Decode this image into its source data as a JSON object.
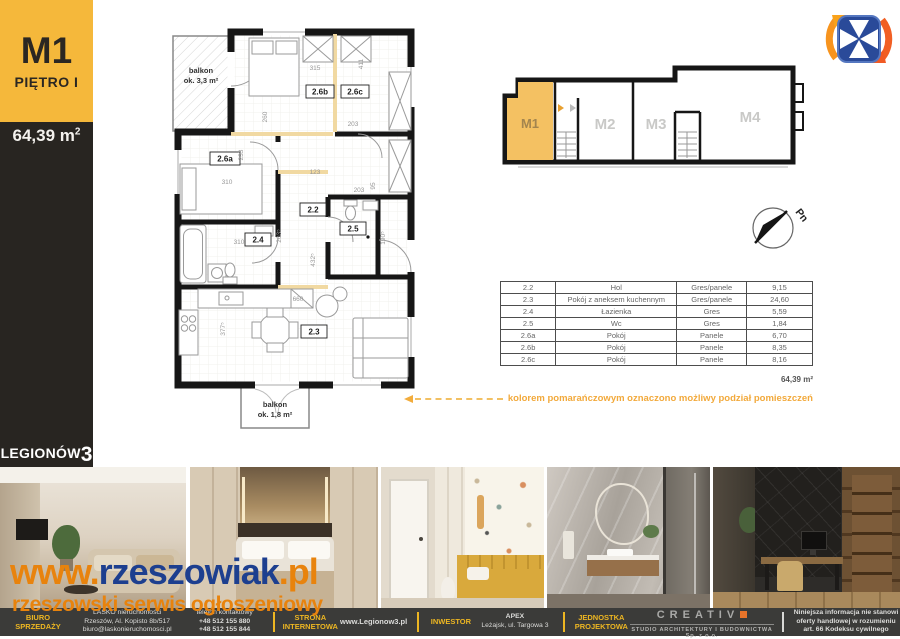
{
  "sidebar": {
    "unit": "M1",
    "floor": "PIĘTRO I",
    "area": "64,39 m",
    "area_sup": "2",
    "project_name": "LEGIONÓW",
    "project_number": "3"
  },
  "plan": {
    "balcony_top": {
      "label": "balkon",
      "area": "ok. 3,3 m²"
    },
    "balcony_bottom": {
      "label": "balkon",
      "area": "ok. 1,8 m²"
    },
    "rooms": {
      "r26a": "2.6a",
      "r26b": "2.6b",
      "r26c": "2.6c",
      "r22": "2.2",
      "r23": "2.3",
      "r24": "2.4",
      "r25": "2.5"
    },
    "dims": {
      "d315": "315",
      "d411": "411",
      "d260": "260",
      "d203a": "203",
      "d233": "233",
      "d310a": "310",
      "d123": "123",
      "d203b": "203",
      "d95": "95",
      "d310b": "310",
      "d2035": "203⁵",
      "d4325": "432⁵",
      "d1905": "190⁵",
      "d660": "660",
      "d3775": "377⁵"
    }
  },
  "overview": {
    "m1": "M1",
    "m2": "M2",
    "m3": "M3",
    "m4": "M4"
  },
  "compass": {
    "label": "Pn"
  },
  "table": {
    "rows": [
      {
        "id": "2.2",
        "name": "Hol",
        "floor": "Gres/panele",
        "area": "9,15"
      },
      {
        "id": "2.3",
        "name": "Pokój z aneksem kuchennym",
        "floor": "Gres/panele",
        "area": "24,60"
      },
      {
        "id": "2.4",
        "name": "Łazienka",
        "floor": "Gres",
        "area": "5,59"
      },
      {
        "id": "2.5",
        "name": "Wc",
        "floor": "Gres",
        "area": "1,84"
      },
      {
        "id": "2.6a",
        "name": "Pokój",
        "floor": "Panele",
        "area": "6,70"
      },
      {
        "id": "2.6b",
        "name": "Pokój",
        "floor": "Panele",
        "area": "8,35"
      },
      {
        "id": "2.6c",
        "name": "Pokój",
        "floor": "Panele",
        "area": "8,16"
      }
    ],
    "total": "64,39  m²"
  },
  "note": {
    "text": "kolorem pomarańczowym oznaczono możliwy podział pomieszczeń"
  },
  "watermark": {
    "prefix": "www.",
    "name": "rzeszowiak",
    "tld": ".pl",
    "tagline": "rzeszowski serwis ogłoszeniowy"
  },
  "footer": {
    "office_label_line1": "BIURO",
    "office_label_line2": "SPRZEDAŻY",
    "office_name": "LASKO nieruchomości",
    "office_address": "Rzeszów, Al. Kopisto 8b/517",
    "office_email": "biuro@laskonieruchomosci.pl",
    "phone_label": "telefon kontaktowy",
    "phone_1": "+48 512 155 880",
    "phone_2": "+48 512 155 844",
    "website_label_line1": "STRONA",
    "website_label_line2": "INTERNETOWA",
    "website_url": "www.Legionow3.pl",
    "investor_label": "INWESTOR",
    "investor_name": "APEX",
    "investor_address": "Leżajsk, ul. Targowa 3",
    "design_label_line1": "JEDNOSTKA",
    "design_label_line2": "PROJEKTOWA",
    "design_name": "CREATIV",
    "design_subtitle": "STUDIO ARCHITEKTURY I BUDOWNICTWA Sp. z o.o.",
    "legal_line1": "Niniejsza informacja nie stanowi",
    "legal_line2": "oferty handlowej w rozumieniu",
    "legal_line3": "art. 66 Kodeksu cywilnego"
  },
  "colors": {
    "accent_yellow": "#F5B83B",
    "unit_highlight": "#F4C162",
    "note_orange": "#F2A93B",
    "watermark_orange": "#E8830D",
    "watermark_navy": "#1D3F8F",
    "footer_bg": "#3B3B39"
  }
}
